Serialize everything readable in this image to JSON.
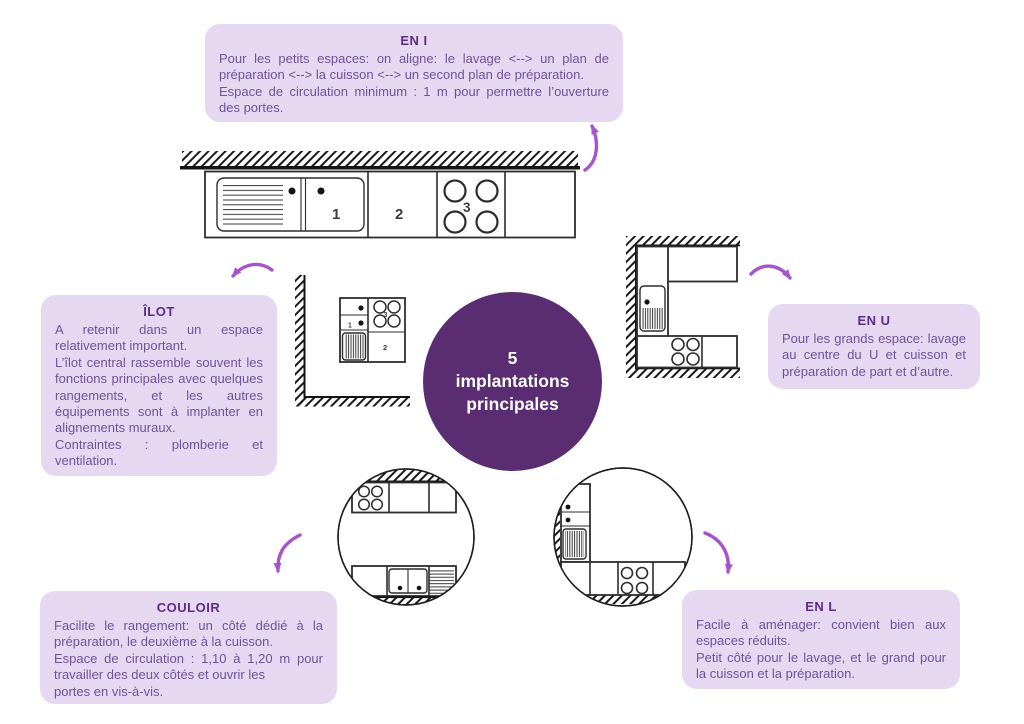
{
  "colors": {
    "box_bg": "#e6d8f1",
    "title_text": "#5d2c85",
    "body_text": "#6f5398",
    "circle_bg": "#5a2c72",
    "circle_text": "#ffffff",
    "arrow": "#a654cb",
    "dline": "#2d2d2d"
  },
  "center_circle": {
    "line1": "5",
    "line2": "implantations",
    "line3": "principales"
  },
  "boxes": {
    "en_i": {
      "title": "EN I",
      "p1": "Pour les petits espaces: on aligne: le lavage <--> un plan de préparation <--> la cuisson <--> un second plan de préparation.",
      "p2": "Espace de circulation minimum : 1 m pour permettre l’ouverture des portes."
    },
    "ilot": {
      "title": "ÎLOT",
      "p1": "A retenir dans un espace relativement important.",
      "p2": "L’îlot central rassemble souvent les fonctions principales avec quelques rangements, et les autres équipements sont à implanter en alignements muraux.",
      "p3": "Contraintes : plomberie et ventilation."
    },
    "en_u": {
      "title": "EN U",
      "p1": "Pour les grands espace: lavage au centre du U et cuisson et préparation de part et d’autre."
    },
    "couloir": {
      "title": "COULOIR",
      "p1": "Facilite le rangement: un côté dédié à la préparation, le deuxième à la cuisson.",
      "p2": "Espace de circulation : 1,10 à 1,20 m pour travailler des deux côtés et ouvrir les",
      "p3": "portes en vis-à-vis."
    },
    "en_l": {
      "title": "EN L",
      "p1": "Facile à aménager: convient bien aux espaces réduits.",
      "p2": "Petit côté pour le lavage, et le grand pour la cuisson et la préparation."
    }
  },
  "diagram_labels": {
    "sink": "1",
    "prep": "2",
    "cook": "3"
  }
}
